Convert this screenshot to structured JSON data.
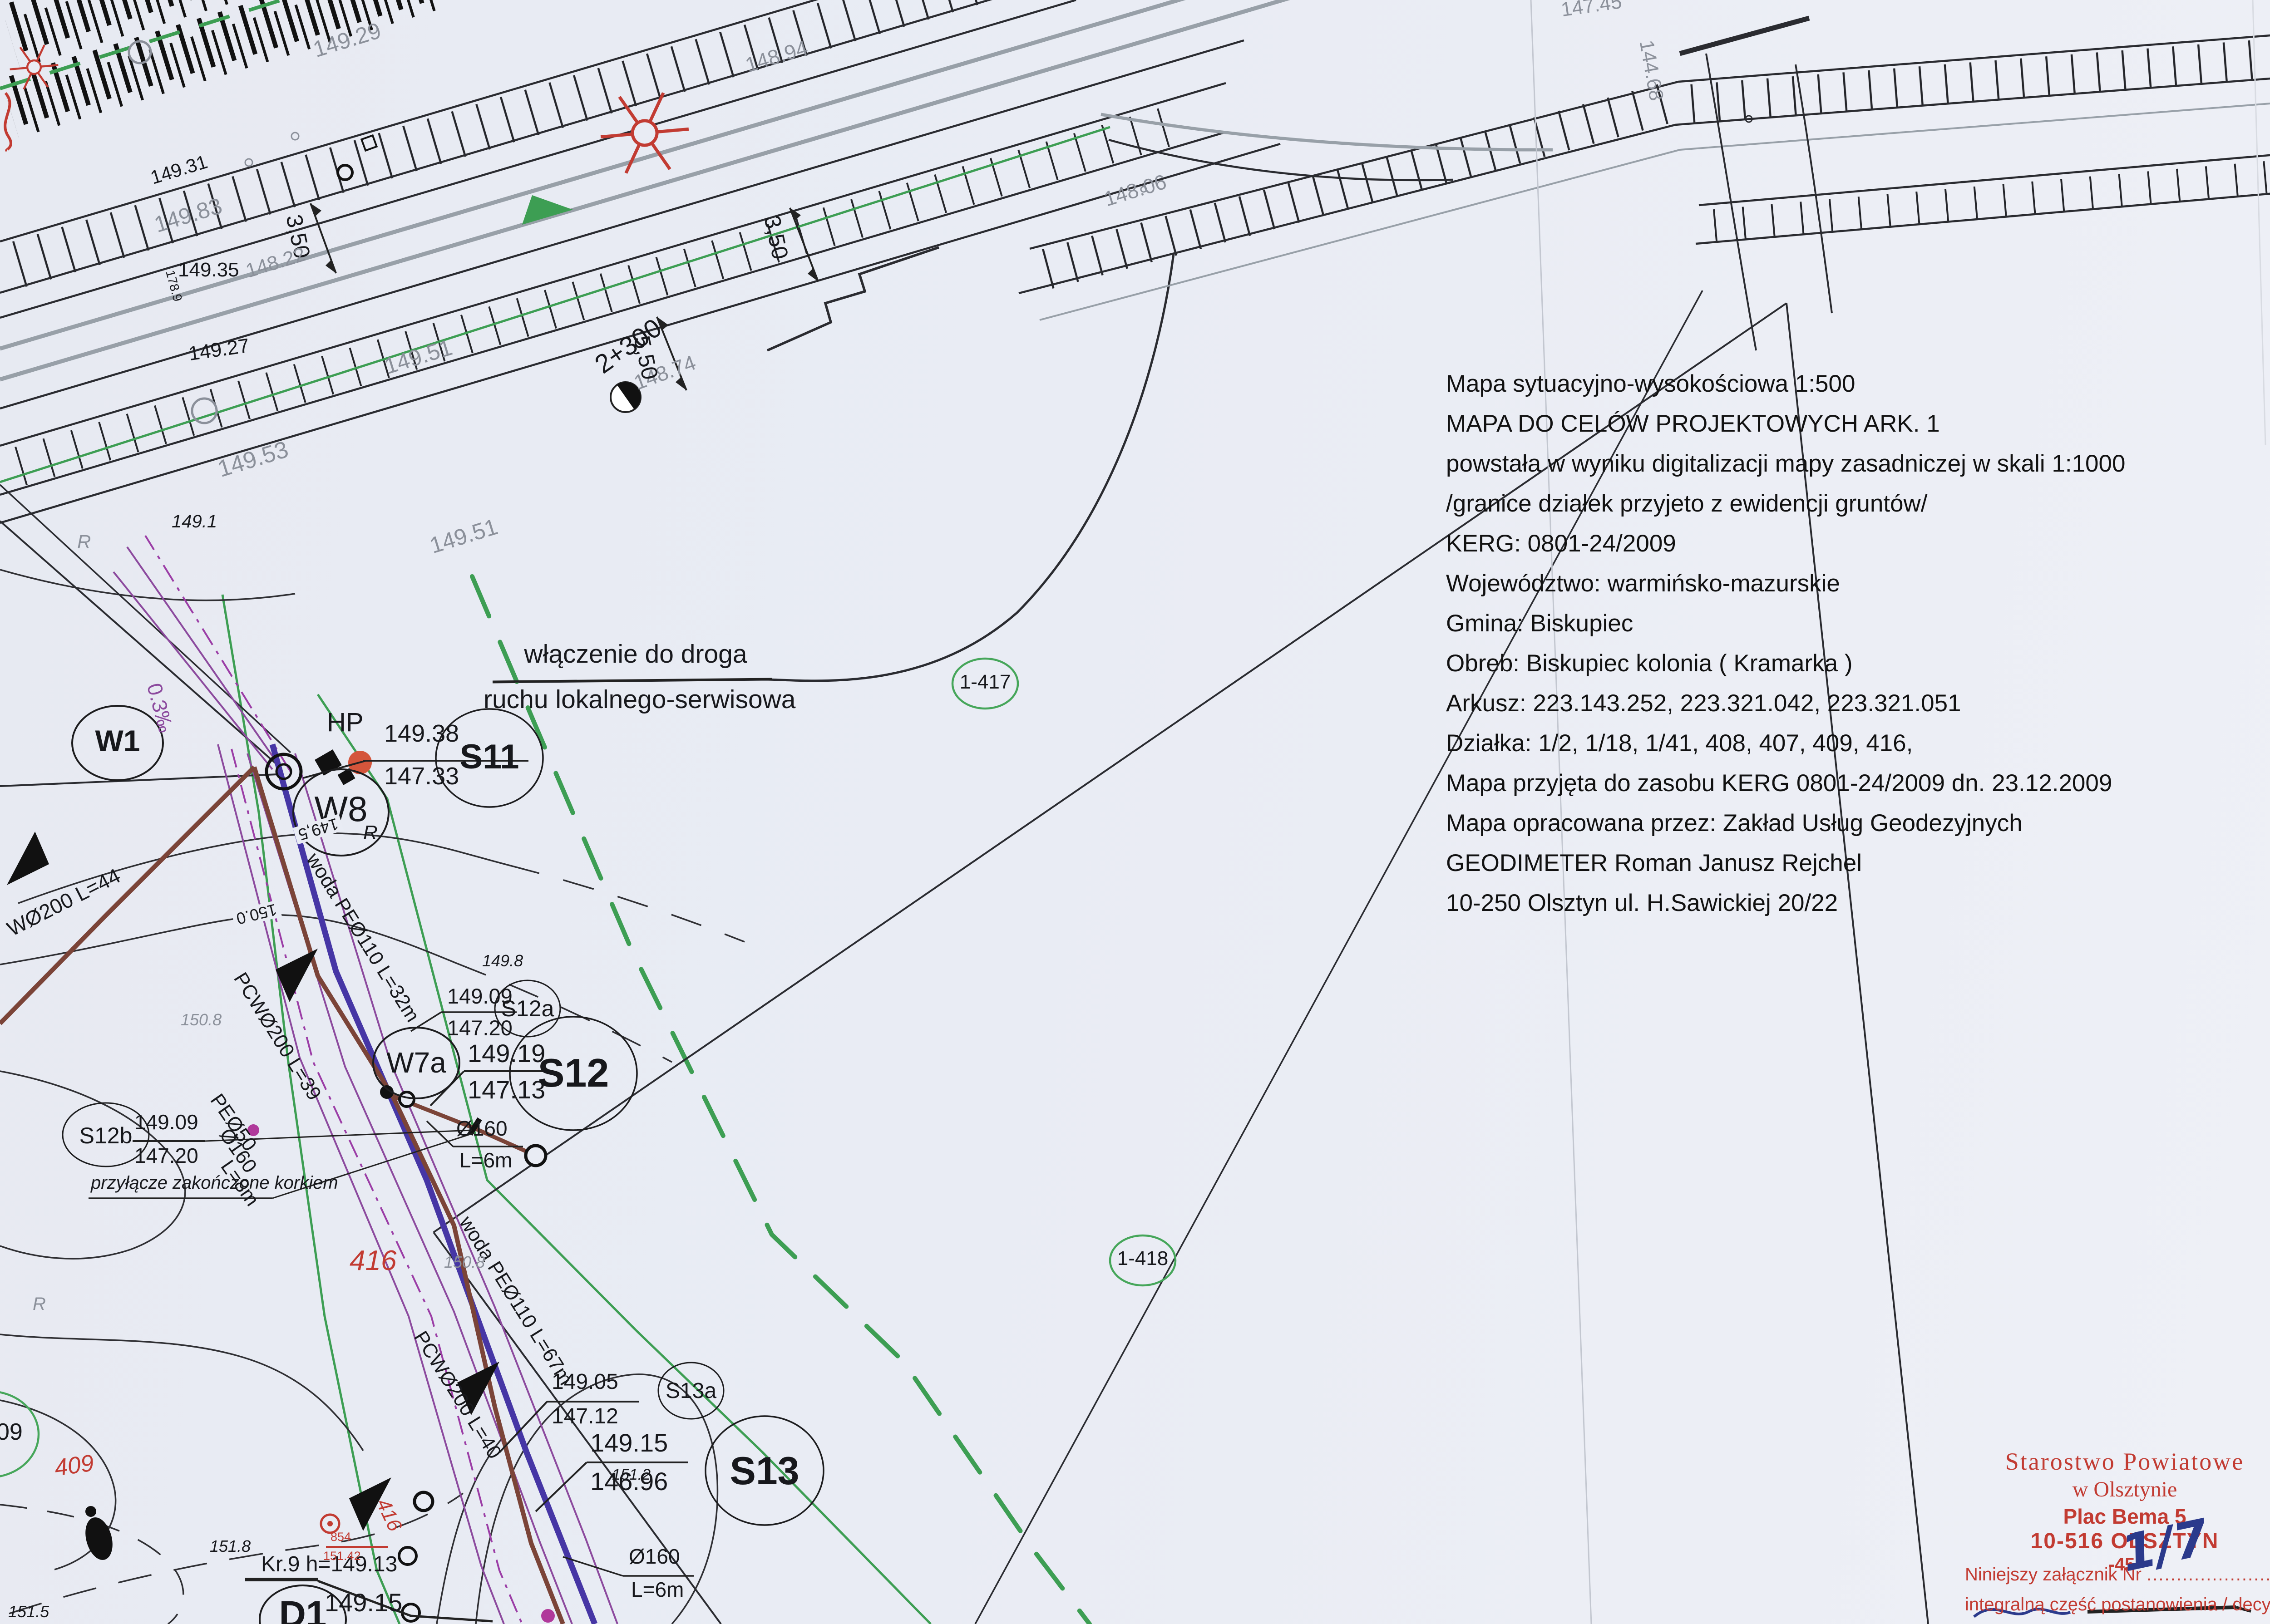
{
  "colors": {
    "paper": "#e9ecf4",
    "red_stamp": "#c23b32",
    "green": "#3d9e53",
    "purple": "#8c4a9e",
    "navy": "#4636a5",
    "brown": "#7b4438",
    "gray_label": "#8b909a",
    "ink_blue": "#2b3a8c"
  },
  "info": {
    "lines": [
      "Mapa sytuacyjno-wysokościowa 1:500",
      "MAPA DO CELÓW PROJEKTOWYCH ARK. 1",
      "powstała w wyniku digitalizacji mapy zasadniczej w skali 1:1000",
      "/granice działek przyjeto z ewidencji gruntów/",
      "KERG: 0801-24/2009",
      "Województwo: warmińsko-mazurskie",
      "Gmina: Biskupiec",
      "Obreb: Biskupiec kolonia ( Kramarka )",
      "Arkusz: 223.143.252, 223.321.042, 223.321.051",
      "Działka: 1/2, 1/18, 1/41, 408, 407, 409, 416,",
      "Mapa przyjęta do zasobu KERG 0801-24/2009 dn. 23.12.2009",
      "Mapa opracowana przez: Zakład Usług Geodezyjnych",
      "GEODIMETER Roman Janusz Rejchel",
      "10-250 Olsztyn ul. H.Sawickiej 20/22"
    ]
  },
  "junction": {
    "line1": "włączenie do droga",
    "line2": "ruchu lokalnego-serwisowa"
  },
  "wells": {
    "w1": "W1",
    "w8": "W8",
    "w7a": "W7a",
    "s11": "S11",
    "s12": "S12",
    "s12a": "S12a",
    "s12b": "S12b",
    "s13": "S13",
    "s13a": "S13a",
    "d1": "D1",
    "hp": "HP",
    "r_a": "R",
    "r_b": "R",
    "r_c": "R"
  },
  "callouts": {
    "s11": {
      "top": "149.38",
      "bottom": "147.33"
    },
    "s12a": {
      "top": "149.09",
      "bottom": "147.20"
    },
    "s12": {
      "top": "149.19",
      "bottom": "147.13"
    },
    "s12b": {
      "top": "149.09",
      "bottom": "147.20"
    },
    "s13a": {
      "top": "149.05",
      "bottom": "147.12"
    },
    "s13": {
      "top": "149.15",
      "bottom": "146.96"
    },
    "d1_elev": "149.15",
    "kr9": "Kr.9 h=149.13",
    "connection_note": "przyłącze zakończone korkiem"
  },
  "pipes": {
    "woda32": "woda PEØ110 L=32m",
    "pcw39": "PCWØ200 L=39",
    "woda67": "woda PEØ110 L=67m",
    "pcw40": "PCWØ200 L=40",
    "w200": "WØ200 L=44",
    "pe50": "PEØ50",
    "d160_8": "Ø160",
    "l8": "L=8m",
    "d160_6a": "Ø160",
    "l6a": "L=6m",
    "d160_6b": "Ø160",
    "l6b": "L=6m",
    "slope": "0.3‰"
  },
  "road": {
    "chainage": "2+300",
    "dim_a": "5,50",
    "dim_b": "3,50",
    "dim_c": "3,50"
  },
  "parcels": {
    "c417": "1-417",
    "c418": "1-418",
    "c09": "09",
    "p416": "416",
    "p409": "409",
    "p416b": "416"
  },
  "benchmark": {
    "id": "854",
    "elev": "151.42"
  },
  "elevations": {
    "e14929": "149.29",
    "e14894": "148.94",
    "e14983": "149.83",
    "e14931": "149.31",
    "e14935": "149.35",
    "e1789": "178.9",
    "e14927": "149.27",
    "e14822": "148.22",
    "e14953": "149.53",
    "e14951a": "149.51",
    "e14951b": "149.51",
    "e1491": "149.1",
    "e14874": "148.74",
    "e14806": "148.06",
    "e14745": "147.45",
    "e14468": "144.68",
    "e1495c": "149,5",
    "e1500c": "150.0",
    "e1498": "149.8",
    "e1508a": "150.8",
    "e1508b": "150.8",
    "e1512": "151.2",
    "e1518": "151.8",
    "e1515": "151.5"
  },
  "stamp": {
    "line1": "Starostwo Powiatowe",
    "line2": "w Olsztynie",
    "line3": "Plac Bema 5",
    "line4": "10-516 OLSZTYN",
    "line5": "-45-"
  },
  "attachment": {
    "prefix": "Niniejszy załącznik Nr",
    "dots": "..........................",
    "suffix": "stanowi",
    "number": "1/7",
    "line2": "integralną część postanowienia / decyzji"
  }
}
